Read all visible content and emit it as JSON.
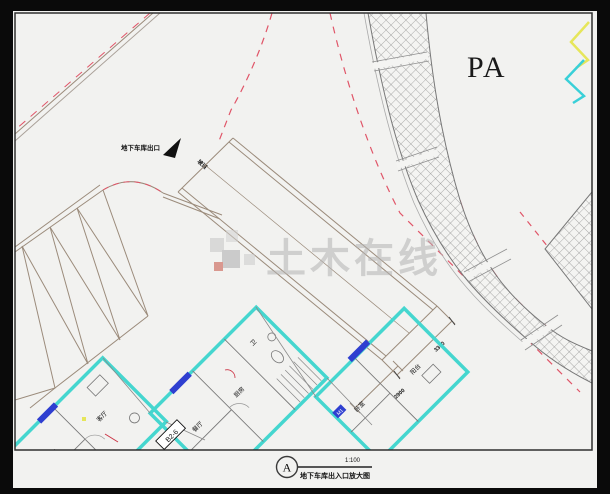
{
  "plan": {
    "zone_label": "PA",
    "exit_label": "地下车库出口",
    "ramp_label": "坡道",
    "dims": {
      "d1": "3300",
      "d2": "2900"
    },
    "rooms": [
      "卧室",
      "客厅",
      "餐厅",
      "厨房",
      "卫",
      "卧室",
      "阳台"
    ],
    "unit_tag": "B2-6",
    "door_tag": "M1",
    "colors": {
      "wall_cyan": "#45d6cf",
      "road_dash_red": "#e05568",
      "hatch_gray": "#8f8f8f",
      "line_brown": "#9b8b7b",
      "window_blue": "#2f3fd0",
      "marker_yellow": "#e6e65a",
      "marker_cyan": "#39d0d8",
      "sheet": "#f2f2f0",
      "background": "#0a0a0a"
    }
  },
  "title_block": {
    "bubble": "A",
    "scale": "1:100",
    "caption": "地下车库出入口放大图"
  },
  "watermark": {
    "text": "土木在线"
  }
}
